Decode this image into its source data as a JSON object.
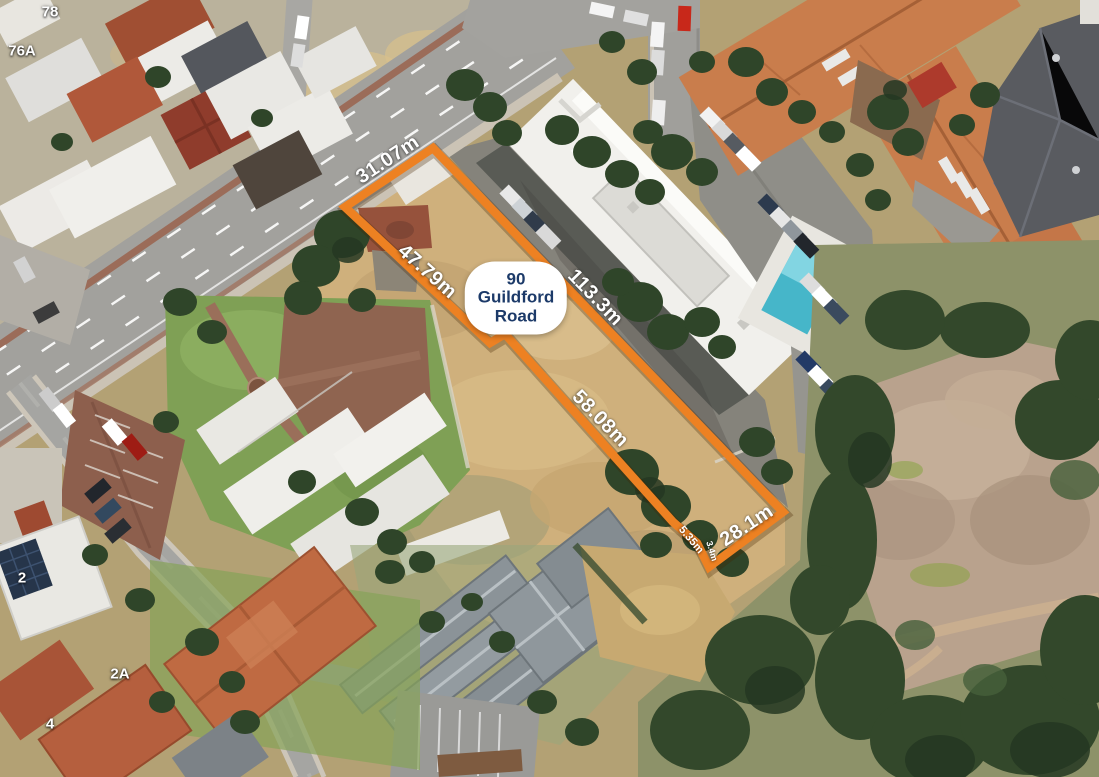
{
  "map_type": "aerial-satellite-property-view",
  "colors": {
    "boundary_orange": "#ED8122",
    "pill_text_navy": "#1C3A69",
    "dimension_label_white": "#FFFFFF"
  },
  "property_marker": {
    "line1": "90",
    "line2": "Guildford",
    "line3": "Road"
  },
  "dimensions": [
    {
      "label": "31.07m"
    },
    {
      "label": "47.79m"
    },
    {
      "label": "113.3m"
    },
    {
      "label": "58.08m"
    },
    {
      "label": "5.35m"
    },
    {
      "label": "3.4m"
    },
    {
      "label": "28.1m"
    }
  ],
  "house_numbers": [
    {
      "label": "78"
    },
    {
      "label": "76A"
    },
    {
      "label": "2"
    },
    {
      "label": "2A"
    },
    {
      "label": "4"
    }
  ]
}
